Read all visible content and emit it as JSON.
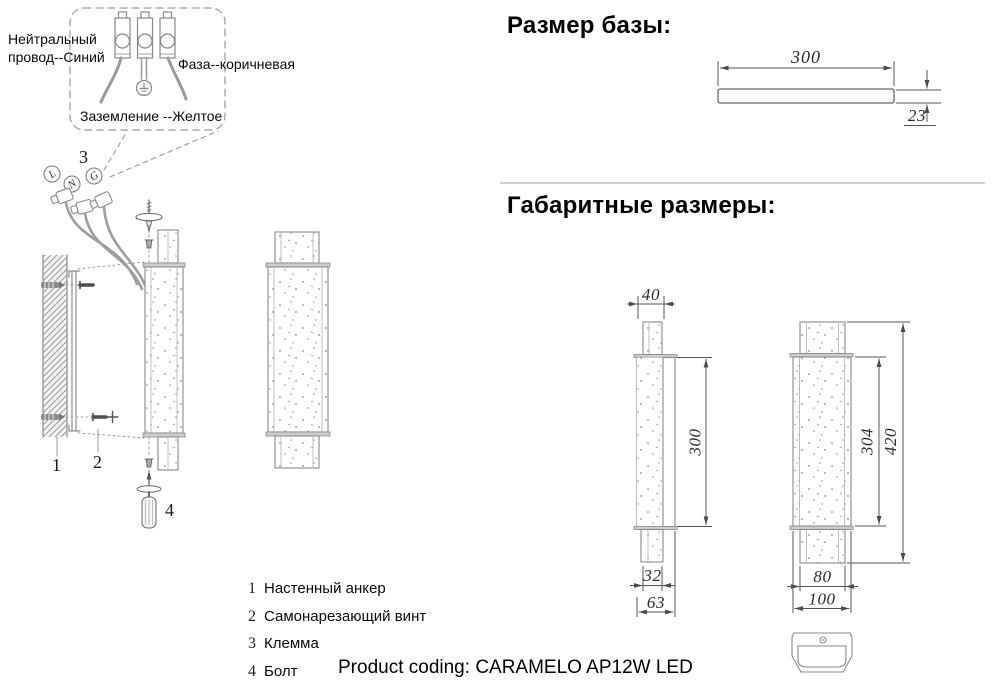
{
  "wiring": {
    "neutral_label": "Нейтральный провод--Синий",
    "phase_label": "Фаза--коричневая",
    "ground_label": "Заземление --Желтое",
    "terminals": [
      "L",
      "N",
      "G"
    ]
  },
  "callouts": {
    "anchor": "1",
    "screw": "2",
    "terminal": "3",
    "bolt": "4"
  },
  "legend": [
    {
      "num": "1",
      "label": "Настенный анкер"
    },
    {
      "num": "2",
      "label": "Самонарезающий винт"
    },
    {
      "num": "3",
      "label": "Клемма"
    },
    {
      "num": "4",
      "label": "Болт"
    }
  ],
  "base_size": {
    "heading": "Размер базы:",
    "width": "300",
    "thickness": "23"
  },
  "overall": {
    "heading": "Габаритные размеры:",
    "side_view": {
      "top_width": "40",
      "body_height": "300",
      "bottom_width": "32",
      "depth": "63"
    },
    "front_view": {
      "body_height": "304",
      "total_height": "420",
      "tube_width": "80",
      "base_width": "100"
    }
  },
  "footer": {
    "label": "Product coding:",
    "value": "CARAMELO AP12W LED"
  }
}
